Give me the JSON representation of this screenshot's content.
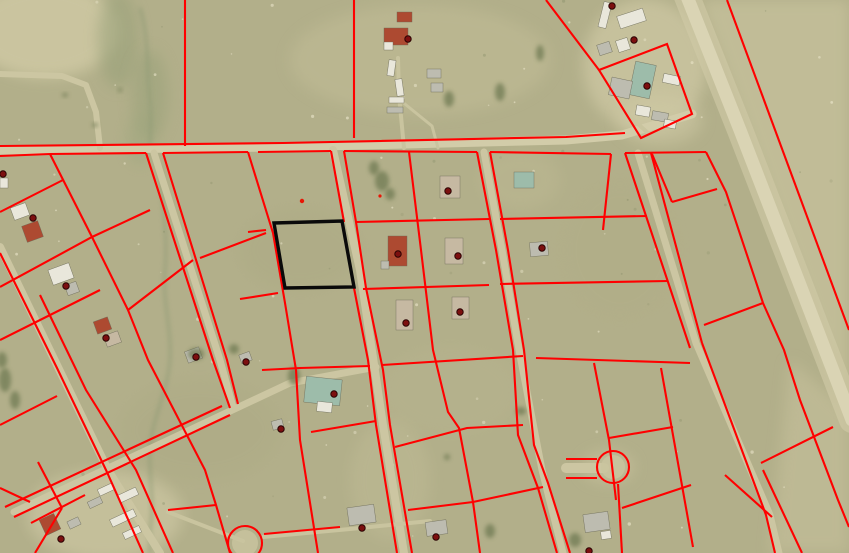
{
  "meta": {
    "title": "aerial-parcel-map",
    "width": 849,
    "height": 553
  },
  "map": {
    "colors": {
      "field": "#b2af8a",
      "fieldLight": "#c6c19c",
      "parcelLine": "#ff0000",
      "selectedParcel": "#0a0a0a",
      "pointMarker": "#7c0f0f",
      "pointMarkerEdge": "#2b0303",
      "roadMain": "#d2cca9",
      "street": "#ccc6a2",
      "path": "#c9c49f",
      "hwy": "#dad4b4",
      "hwyShoulder": "#cfc9a6",
      "creek": "#8e9a74",
      "tree": "#6f7a52",
      "bWhite": "#e9e7db",
      "bGray": "#bdbcb0",
      "bTan": "#c6b9a2",
      "bRed": "#ad4a31",
      "bGreen": "#9dbcaa"
    },
    "patches": [
      {
        "kind": "ellipse",
        "cx": 45,
        "cy": 30,
        "rx": 75,
        "ry": 48,
        "fill": "#cdc7a2",
        "o": 0.9
      },
      {
        "kind": "ellipse",
        "cx": 420,
        "cy": 60,
        "rx": 130,
        "ry": 55,
        "fill": "#c2bd97",
        "o": 0.5
      },
      {
        "kind": "ellipse",
        "cx": 118,
        "cy": 40,
        "rx": 20,
        "ry": 48,
        "fill": "#97a078",
        "o": 0.55
      },
      {
        "kind": "ellipse",
        "cx": 150,
        "cy": 95,
        "rx": 18,
        "ry": 45,
        "fill": "#97a078",
        "o": 0.5
      },
      {
        "kind": "ellipse",
        "cx": 140,
        "cy": 140,
        "rx": 14,
        "ry": 25,
        "fill": "#9aa47c",
        "o": 0.4
      },
      {
        "kind": "ellipse",
        "cx": 645,
        "cy": 65,
        "rx": 62,
        "ry": 66,
        "fill": "#cdc7a3",
        "o": 0.75
      },
      {
        "kind": "poly",
        "d": "M700,0 L849,0 L849,420 Z",
        "fill": "#c8c29d",
        "o": 0.7
      },
      {
        "kind": "poly",
        "d": "M790,360 L849,410 L849,553 L770,553 Z",
        "fill": "#c9c39e",
        "o": 0.5
      },
      {
        "kind": "ellipse",
        "cx": 300,
        "cy": 250,
        "rx": 60,
        "ry": 40,
        "fill": "#a9a781",
        "o": 0.3
      },
      {
        "kind": "ellipse",
        "cx": 200,
        "cy": 430,
        "rx": 80,
        "ry": 50,
        "fill": "#aaa882",
        "o": 0.3
      },
      {
        "kind": "ellipse",
        "cx": 450,
        "cy": 390,
        "rx": 70,
        "ry": 45,
        "fill": "#b9b590",
        "o": 0.35
      },
      {
        "kind": "ellipse",
        "cx": 620,
        "cy": 250,
        "rx": 60,
        "ry": 70,
        "fill": "#b0ad86",
        "o": 0.3
      },
      {
        "kind": "ellipse",
        "cx": 520,
        "cy": 180,
        "rx": 40,
        "ry": 30,
        "fill": "#c0bb94",
        "o": 0.4
      },
      {
        "kind": "ellipse",
        "cx": 105,
        "cy": 515,
        "rx": 78,
        "ry": 45,
        "fill": "#ccc6a2",
        "o": 0.7
      },
      {
        "kind": "ellipse",
        "cx": 660,
        "cy": 120,
        "rx": 42,
        "ry": 25,
        "fill": "#d0caa6",
        "o": 0.5
      },
      {
        "kind": "ellipse",
        "cx": 390,
        "cy": 480,
        "rx": 40,
        "ry": 60,
        "fill": "#c3be98",
        "o": 0.4
      },
      {
        "kind": "ellipse",
        "cx": 608,
        "cy": 467,
        "rx": 26,
        "ry": 16,
        "fill": "#c9c39f",
        "o": 0.6
      }
    ],
    "creeks": [
      "M140,8 C150,40 146,70 150,100 C152,120 150,132 150,146",
      "M160,166 C163,210 168,240 165,270 C162,300 172,330 170,360 C168,390 152,420 150,447 C148,470 155,500 150,530 L150,553"
    ],
    "roads": [
      {
        "d": "M0,150 L283,147 L566,140 L622,135 L692,114",
        "w": 9,
        "c": "roadMain"
      },
      {
        "d": "M686,-6 L740,130 L800,285 L852,420",
        "w": 26,
        "c": "hwyShoulder",
        "o": 0.65
      },
      {
        "d": "M686,-6 L740,130 L800,285 L852,420",
        "w": 13,
        "c": "hwy"
      },
      {
        "d": "M333,150 L360,270 L383,425 L404,553",
        "w": 8,
        "c": "street"
      },
      {
        "d": "M484,152 L502,250 L519,350 L542,470 L563,553",
        "w": 7,
        "c": "street"
      },
      {
        "d": "M154,153 L220,360 L233,407",
        "w": 7,
        "c": "street"
      },
      {
        "d": "M0,247 L57,365 L108,470 L160,553",
        "w": 8,
        "c": "street"
      },
      {
        "d": "M14,512 L160,444 L290,383 L376,367",
        "w": 7,
        "c": "street"
      },
      {
        "d": "M638,153 L696,343 L770,515 L779,553",
        "w": 7,
        "c": "street"
      },
      {
        "d": "M168,512 L243,541",
        "w": 4,
        "c": "path"
      },
      {
        "d": "M263,537 L350,529 L430,521",
        "w": 4,
        "c": "path"
      },
      {
        "d": "M566,468 L604,468",
        "w": 10,
        "c": "street"
      },
      {
        "d": "M0,74 L62,76 L86,85 L96,112 L100,148",
        "w": 6,
        "c": "street"
      },
      {
        "d": "M404,148 L399,95 L398,58",
        "w": 4,
        "c": "path"
      },
      {
        "d": "M400,100 L432,126 L438,148",
        "w": 3,
        "c": "path"
      },
      {
        "d": "M648,133 L628,115 L614,97",
        "w": 4,
        "c": "path"
      }
    ],
    "parcel_lines": [
      "M185,0 L185,146",
      "M354,0 L354,138",
      "M546,0 L599,70",
      "M599,70 L667,44 L692,114 L641,138 Z",
      "M727,0 L849,330",
      "M0,146 L283,143 L566,137 L625,133",
      "M0,156 L50,154 L146,153",
      "M163,153 L248,152",
      "M258,152 L331,151",
      "M344,151 L477,152",
      "M490,152 L611,154",
      "M625,153 L706,152",
      "M611,154 L603,230",
      "M248,152 L273,233 L285,303 L296,370 L300,440 L318,553",
      "M331,151 L344,222",
      "M354,288 L368,360 L376,425 L397,553",
      "M344,151 L356,222 L366,288 L383,370 L390,425 L412,553",
      "M409,152 L421,250 L433,350 L448,412 L459,428 L473,502 L480,553",
      "M477,152 L496,250 L513,350 L518,435 L538,488 L557,553",
      "M490,152 L508,250 L524,350 L534,445 L548,483 L570,553",
      "M625,153 L690,348",
      "M651,153 L702,343",
      "M661,368 L693,547",
      "M702,343 L766,515 L775,553",
      "M706,152 L726,192 L763,303 L784,350 L800,400 L838,500 L849,527",
      "M652,154 L672,202",
      "M672,202 L717,189",
      "M248,232 L266,230",
      "M356,222 L489,219",
      "M500,219 L647,216",
      "M240,299 L278,293",
      "M363,289 L489,285",
      "M500,284 L668,281",
      "M262,370 L300,368 L370,366",
      "M382,365 L523,356",
      "M536,358 L690,363",
      "M311,432 L376,421",
      "M395,447 L467,428 L523,425",
      "M609,438 L673,427",
      "M168,510 L216,505",
      "M264,534 L340,527",
      "M408,510 L473,502 L543,487",
      "M704,325 L763,303",
      "M761,463 L833,427",
      "M725,475 L772,517",
      "M763,470 L802,553",
      "M566,459 L597,459",
      "M566,478 L597,478",
      "M618,484 L622,553",
      "M622,508 L691,485",
      "M594,363 L609,440 L616,500",
      "M50,154 L92,237 L128,310 L148,360 L205,470 L216,505 L230,553",
      "M0,253 L57,368 L106,470 L143,553",
      "M40,295 L86,390 L136,470 L173,553",
      "M146,153 L213,360 L230,408",
      "M163,153 L227,360 L238,404",
      "M0,212 L63,180",
      "M0,287 L92,237 L150,210",
      "M128,310 L193,260",
      "M200,258 L266,233",
      "M0,340 L100,290",
      "M0,425 L57,396",
      "M0,488 L30,502",
      "M35,553 L62,508",
      "M62,508 L38,462",
      "M31,523 L85,495",
      "M14,517 L230,415",
      "M5,507 L222,406"
    ],
    "cul_de_sacs": [
      {
        "cx": 613,
        "cy": 467,
        "r": 16
      },
      {
        "cx": 245,
        "cy": 543,
        "r": 17
      }
    ],
    "selected_parcel": {
      "d": "M274,223 L342,221 L354,287 L285,288 Z",
      "stroke_width": 3.4
    },
    "buildings": [
      {
        "x": 601,
        "y": 2,
        "w": 8,
        "h": 26,
        "r": 14,
        "c": "bWhite"
      },
      {
        "x": 618,
        "y": 12,
        "w": 27,
        "h": 13,
        "r": -18,
        "c": "bWhite"
      },
      {
        "x": 598,
        "y": 43,
        "w": 13,
        "h": 11,
        "r": -18,
        "c": "bGray"
      },
      {
        "x": 617,
        "y": 39,
        "w": 12,
        "h": 12,
        "r": -18,
        "c": "bWhite"
      },
      {
        "x": 632,
        "y": 63,
        "w": 21,
        "h": 34,
        "r": 12,
        "c": "bGreen"
      },
      {
        "x": 610,
        "y": 79,
        "w": 21,
        "h": 18,
        "r": 12,
        "c": "bGray"
      },
      {
        "x": 663,
        "y": 75,
        "w": 17,
        "h": 9,
        "r": 12,
        "c": "bWhite"
      },
      {
        "x": 636,
        "y": 106,
        "w": 14,
        "h": 10,
        "r": 10,
        "c": "bWhite"
      },
      {
        "x": 652,
        "y": 112,
        "w": 16,
        "h": 9,
        "r": 10,
        "c": "bGray"
      },
      {
        "x": 664,
        "y": 120,
        "w": 12,
        "h": 8,
        "r": 10,
        "c": "bWhite"
      },
      {
        "x": 397,
        "y": 12,
        "w": 15,
        "h": 10,
        "r": 0,
        "c": "bRed"
      },
      {
        "x": 384,
        "y": 28,
        "w": 24,
        "h": 17,
        "r": 0,
        "c": "bRed"
      },
      {
        "x": 384,
        "y": 42,
        "w": 9,
        "h": 8,
        "r": 0,
        "c": "bWhite"
      },
      {
        "x": 388,
        "y": 60,
        "w": 7,
        "h": 16,
        "r": 8,
        "c": "bWhite"
      },
      {
        "x": 396,
        "y": 79,
        "w": 7,
        "h": 17,
        "r": -8,
        "c": "bWhite"
      },
      {
        "x": 389,
        "y": 97,
        "w": 15,
        "h": 6,
        "r": 0,
        "c": "bWhite"
      },
      {
        "x": 387,
        "y": 107,
        "w": 16,
        "h": 6,
        "r": 0,
        "c": "bGray"
      },
      {
        "x": 427,
        "y": 69,
        "w": 14,
        "h": 9,
        "r": 0,
        "c": "bGray"
      },
      {
        "x": 431,
        "y": 83,
        "w": 12,
        "h": 9,
        "r": 0,
        "c": "bGray"
      },
      {
        "x": 440,
        "y": 176,
        "w": 20,
        "h": 22,
        "r": 0,
        "c": "bTan"
      },
      {
        "x": 514,
        "y": 172,
        "w": 20,
        "h": 16,
        "r": 0,
        "c": "bGreen"
      },
      {
        "x": 388,
        "y": 236,
        "w": 19,
        "h": 30,
        "r": 0,
        "c": "bRed"
      },
      {
        "x": 381,
        "y": 261,
        "w": 8,
        "h": 8,
        "r": 0,
        "c": "bGray"
      },
      {
        "x": 445,
        "y": 238,
        "w": 18,
        "h": 26,
        "r": 0,
        "c": "bTan"
      },
      {
        "x": 530,
        "y": 242,
        "w": 18,
        "h": 14,
        "r": -5,
        "c": "bGray"
      },
      {
        "x": 396,
        "y": 300,
        "w": 17,
        "h": 30,
        "r": 0,
        "c": "bTan"
      },
      {
        "x": 452,
        "y": 297,
        "w": 17,
        "h": 22,
        "r": 0,
        "c": "bTan"
      },
      {
        "x": 12,
        "y": 205,
        "w": 16,
        "h": 13,
        "r": -20,
        "c": "bWhite"
      },
      {
        "x": 24,
        "y": 223,
        "w": 17,
        "h": 17,
        "r": -20,
        "c": "bRed"
      },
      {
        "x": 50,
        "y": 266,
        "w": 22,
        "h": 16,
        "r": -20,
        "c": "bWhite"
      },
      {
        "x": 66,
        "y": 283,
        "w": 12,
        "h": 11,
        "r": -20,
        "c": "bGray"
      },
      {
        "x": 95,
        "y": 319,
        "w": 15,
        "h": 13,
        "r": -20,
        "c": "bRed"
      },
      {
        "x": 105,
        "y": 333,
        "w": 15,
        "h": 12,
        "r": -20,
        "c": "bTan"
      },
      {
        "x": 305,
        "y": 378,
        "w": 36,
        "h": 26,
        "r": 6,
        "c": "bGreen"
      },
      {
        "x": 317,
        "y": 402,
        "w": 15,
        "h": 10,
        "r": 6,
        "c": "bWhite"
      },
      {
        "x": 186,
        "y": 349,
        "w": 15,
        "h": 12,
        "r": -20,
        "c": "bGray"
      },
      {
        "x": 240,
        "y": 353,
        "w": 11,
        "h": 9,
        "r": -20,
        "c": "bGray"
      },
      {
        "x": 272,
        "y": 420,
        "w": 11,
        "h": 9,
        "r": -15,
        "c": "bGray"
      },
      {
        "x": 98,
        "y": 486,
        "w": 16,
        "h": 7,
        "r": -25,
        "c": "bWhite"
      },
      {
        "x": 118,
        "y": 491,
        "w": 20,
        "h": 8,
        "r": -25,
        "c": "bWhite"
      },
      {
        "x": 88,
        "y": 499,
        "w": 14,
        "h": 7,
        "r": -25,
        "c": "bGray"
      },
      {
        "x": 110,
        "y": 514,
        "w": 26,
        "h": 8,
        "r": -25,
        "c": "bWhite"
      },
      {
        "x": 68,
        "y": 519,
        "w": 12,
        "h": 8,
        "r": -25,
        "c": "bGray"
      },
      {
        "x": 123,
        "y": 529,
        "w": 18,
        "h": 7,
        "r": -25,
        "c": "bWhite"
      },
      {
        "x": 42,
        "y": 516,
        "w": 16,
        "h": 17,
        "r": -25,
        "c": "bRed"
      },
      {
        "x": 348,
        "y": 506,
        "w": 27,
        "h": 18,
        "r": -8,
        "c": "bGray"
      },
      {
        "x": 426,
        "y": 521,
        "w": 21,
        "h": 14,
        "r": -8,
        "c": "bGray"
      },
      {
        "x": 584,
        "y": 513,
        "w": 25,
        "h": 18,
        "r": -8,
        "c": "bGray"
      },
      {
        "x": 601,
        "y": 531,
        "w": 10,
        "h": 8,
        "r": -8,
        "c": "bWhite"
      },
      {
        "x": 0,
        "y": 178,
        "w": 8,
        "h": 10,
        "r": 0,
        "c": "bWhite"
      }
    ],
    "trees": [
      {
        "cx": 382,
        "cy": 181,
        "rx": 7,
        "ry": 10
      },
      {
        "cx": 374,
        "cy": 168,
        "rx": 5,
        "ry": 7
      },
      {
        "cx": 390,
        "cy": 194,
        "rx": 5,
        "ry": 6
      },
      {
        "cx": 449,
        "cy": 99,
        "rx": 5,
        "ry": 8
      },
      {
        "cx": 500,
        "cy": 92,
        "rx": 5,
        "ry": 9
      },
      {
        "cx": 540,
        "cy": 53,
        "rx": 4,
        "ry": 8
      },
      {
        "cx": 294,
        "cy": 376,
        "rx": 6,
        "ry": 9
      },
      {
        "cx": 196,
        "cy": 354,
        "rx": 8,
        "ry": 6
      },
      {
        "cx": 234,
        "cy": 349,
        "rx": 5,
        "ry": 5
      },
      {
        "cx": 490,
        "cy": 531,
        "rx": 5,
        "ry": 7
      },
      {
        "cx": 575,
        "cy": 540,
        "rx": 6,
        "ry": 7
      },
      {
        "cx": 447,
        "cy": 457,
        "rx": 3,
        "ry": 3
      },
      {
        "cx": 521,
        "cy": 411,
        "rx": 5,
        "ry": 4
      },
      {
        "cx": 5,
        "cy": 380,
        "rx": 6,
        "ry": 12
      },
      {
        "cx": 15,
        "cy": 400,
        "rx": 5,
        "ry": 9
      },
      {
        "cx": 2,
        "cy": 360,
        "rx": 5,
        "ry": 8
      },
      {
        "cx": 65,
        "cy": 95,
        "rx": 3,
        "ry": 2
      },
      {
        "cx": 95,
        "cy": 125,
        "rx": 3,
        "ry": 2
      },
      {
        "cx": 120,
        "cy": 90,
        "rx": 2,
        "ry": 2
      }
    ],
    "parcel_points": [
      [
        612,
        6
      ],
      [
        408,
        39
      ],
      [
        634,
        40
      ],
      [
        647,
        86
      ],
      [
        3,
        174
      ],
      [
        33,
        218
      ],
      [
        448,
        191
      ],
      [
        398,
        254
      ],
      [
        458,
        256
      ],
      [
        542,
        248
      ],
      [
        66,
        286
      ],
      [
        406,
        323
      ],
      [
        460,
        312
      ],
      [
        106,
        338
      ],
      [
        196,
        357
      ],
      [
        246,
        362
      ],
      [
        334,
        394
      ],
      [
        281,
        429
      ],
      [
        61,
        539
      ],
      [
        362,
        528
      ],
      [
        436,
        537
      ],
      [
        589,
        551
      ]
    ],
    "small_marks": [
      {
        "x": 302,
        "y": 201,
        "r": 2.2
      },
      {
        "x": 380,
        "y": 196,
        "r": 1.6
      }
    ],
    "speckles": {
      "seed": 42,
      "light_count": 70,
      "dark_count": 30
    }
  }
}
